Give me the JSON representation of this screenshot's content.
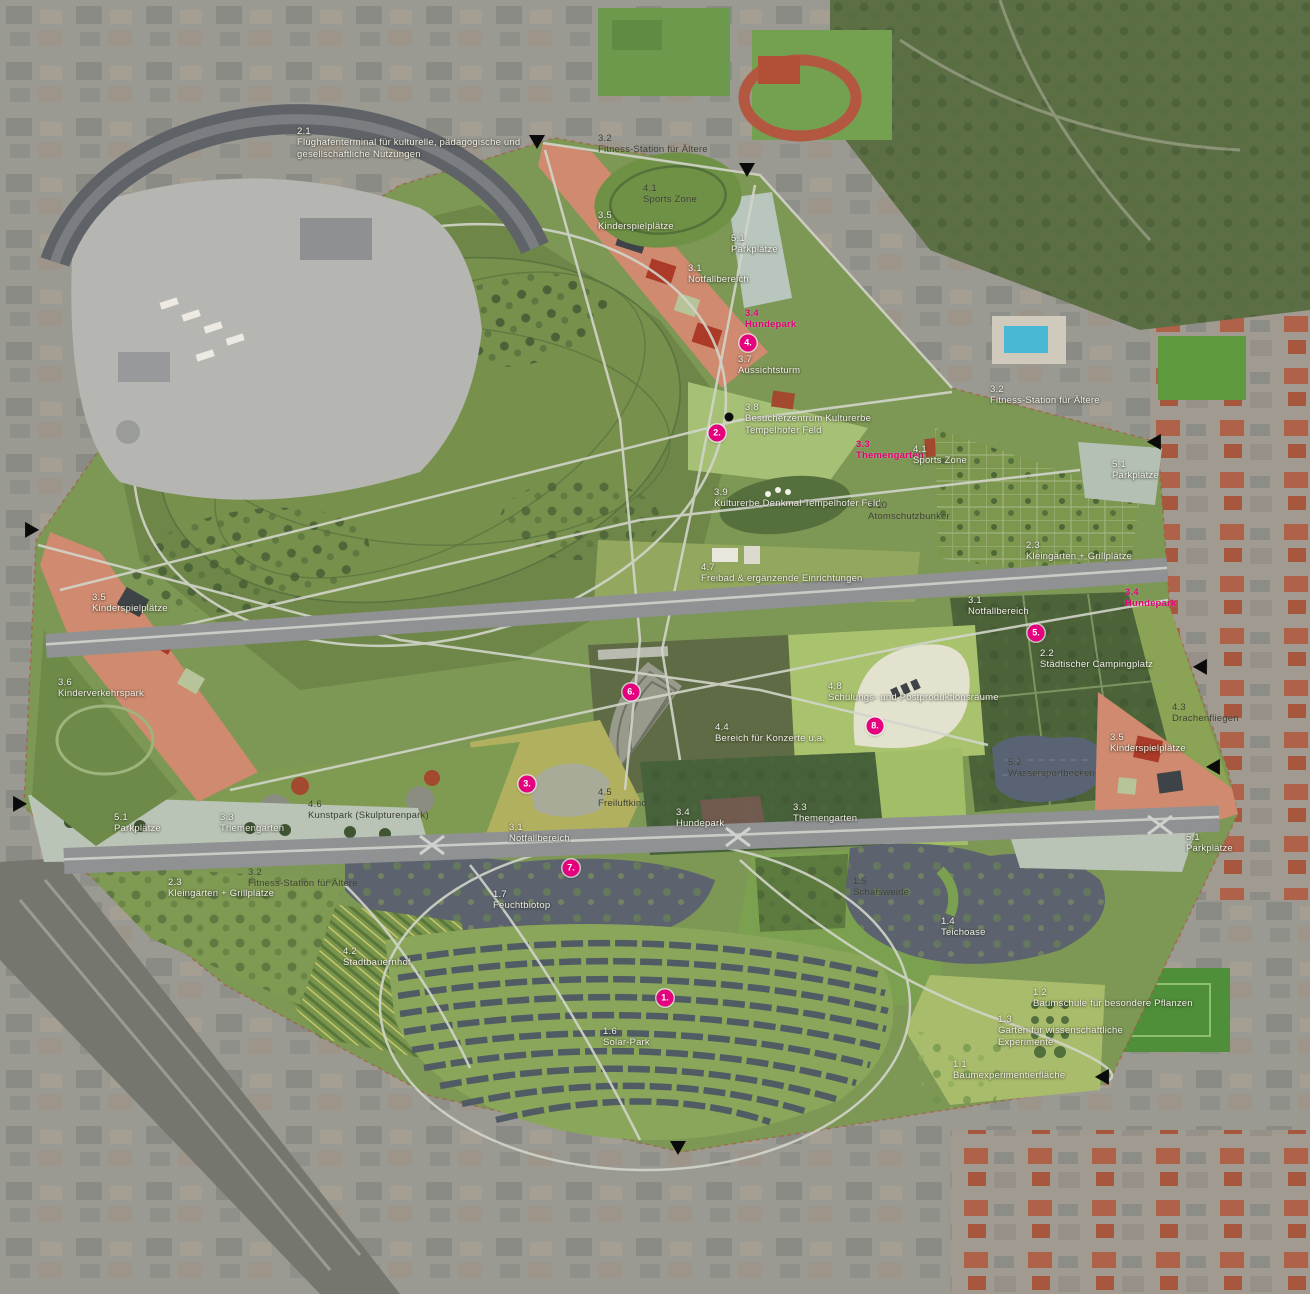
{
  "map_title": "Tempelhofer Feld Masterplan – Luftbild mit Nutzungszonen",
  "palette": {
    "accent": "#e5007d",
    "label_light": "#f0efe6",
    "label_dark": "#3a3e31"
  },
  "zone_labels": [
    {
      "code": "2.1",
      "name": "Flughafenterminal für kulturelle, pädagogische und gesellschaftliche Nutzungen",
      "x": 297,
      "y": 126,
      "tone": "light",
      "w": 275
    },
    {
      "code": "3.2",
      "name": "Fitness-Station für Ältere",
      "x": 598,
      "y": 133,
      "tone": "dark",
      "w": 170
    },
    {
      "code": "4.1",
      "name": "Sports Zone",
      "x": 643,
      "y": 183,
      "tone": "dark"
    },
    {
      "code": "3.5",
      "name": "Kinderspielplätze",
      "x": 598,
      "y": 210,
      "tone": "light"
    },
    {
      "code": "5.1",
      "name": "Parkplätze",
      "x": 731,
      "y": 233,
      "tone": "light"
    },
    {
      "code": "3.1",
      "name": "Notfallbereich",
      "x": 688,
      "y": 263,
      "tone": "light"
    },
    {
      "code": "3.4",
      "name": "Hundepark",
      "x": 745,
      "y": 308,
      "tone": "magenta"
    },
    {
      "code": "3.7",
      "name": "Aussichtsturm",
      "x": 738,
      "y": 354,
      "tone": "light"
    },
    {
      "code": "3.8",
      "name": "Besucherzentrum Kulturerbe Tempelhofer Feld",
      "x": 745,
      "y": 402,
      "tone": "light",
      "w": 165
    },
    {
      "code": "3.3",
      "name": "Themengarten",
      "x": 856,
      "y": 439,
      "tone": "magenta"
    },
    {
      "code": "4.1",
      "name": "Sports Zone",
      "x": 913,
      "y": 444,
      "tone": "light"
    },
    {
      "code": "3.2",
      "name": "Fitness-Station für Ältere",
      "x": 990,
      "y": 384,
      "tone": "light",
      "w": 220
    },
    {
      "code": "5.1",
      "name": "Parkplätze",
      "x": 1112,
      "y": 459,
      "tone": "light"
    },
    {
      "code": "3.9",
      "name": "Kulturerbe Denkmal Tempelhofer Feld",
      "x": 714,
      "y": 487,
      "tone": "light",
      "w": 230
    },
    {
      "code": "3.10",
      "name": "Atomschutzbunker",
      "x": 868,
      "y": 500,
      "tone": "dark"
    },
    {
      "code": "2.3",
      "name": "Kleingärten + Grillplätze",
      "x": 1026,
      "y": 540,
      "tone": "light",
      "w": 170
    },
    {
      "code": "4.7",
      "name": "Freibad & ergänzende Einrichtungen",
      "x": 701,
      "y": 562,
      "tone": "light",
      "w": 235
    },
    {
      "code": "3.5",
      "name": "Kinderspielplätze",
      "x": 92,
      "y": 592,
      "tone": "light"
    },
    {
      "code": "3.6",
      "name": "Kinderverkehrspark",
      "x": 58,
      "y": 677,
      "tone": "light",
      "w": 130
    },
    {
      "code": "3.1",
      "name": "Notfallbereich",
      "x": 968,
      "y": 595,
      "tone": "light"
    },
    {
      "code": "3.4",
      "name": "Hundepark",
      "x": 1125,
      "y": 587,
      "tone": "magenta"
    },
    {
      "code": "2.2",
      "name": "Städtischer Campingplatz",
      "x": 1040,
      "y": 648,
      "tone": "light",
      "w": 200
    },
    {
      "code": "4.3",
      "name": "Drachenfliegen",
      "x": 1172,
      "y": 702,
      "tone": "dark",
      "w": 110
    },
    {
      "code": "4.8",
      "name": "Schulungs- und Postproduktionsräume",
      "x": 828,
      "y": 681,
      "tone": "light",
      "w": 265
    },
    {
      "code": "4.4",
      "name": "Bereich für Konzerte u.a.",
      "x": 715,
      "y": 722,
      "tone": "light",
      "w": 200
    },
    {
      "code": "5.2",
      "name": "Wassersportbecken",
      "x": 1008,
      "y": 757,
      "tone": "dark",
      "w": 140
    },
    {
      "code": "3.5",
      "name": "Kinderspielplätze",
      "x": 1110,
      "y": 732,
      "tone": "light"
    },
    {
      "code": "5.1",
      "name": "Parkplätze",
      "x": 114,
      "y": 812,
      "tone": "light"
    },
    {
      "code": "3.3",
      "name": "Themengarten",
      "x": 220,
      "y": 812,
      "tone": "light"
    },
    {
      "code": "4.6",
      "name": "Kunstpark (Skulpturenpark)",
      "x": 308,
      "y": 799,
      "tone": "dark",
      "w": 210
    },
    {
      "code": "4.5",
      "name": "Freiluftkino",
      "x": 598,
      "y": 787,
      "tone": "dark"
    },
    {
      "code": "3.1",
      "name": "Notfallbereich",
      "x": 509,
      "y": 822,
      "tone": "light"
    },
    {
      "code": "3.4",
      "name": "Hundepark",
      "x": 676,
      "y": 807,
      "tone": "light"
    },
    {
      "code": "3.3",
      "name": "Themengarten",
      "x": 793,
      "y": 802,
      "tone": "light"
    },
    {
      "code": "2.3",
      "name": "Kleingärten + Grillplätze",
      "x": 168,
      "y": 877,
      "tone": "light",
      "w": 175
    },
    {
      "code": "3.2",
      "name": "Fitness-Station für Ältere",
      "x": 248,
      "y": 867,
      "tone": "dark",
      "w": 210
    },
    {
      "code": "1.7",
      "name": "Feuchtbiotop",
      "x": 493,
      "y": 889,
      "tone": "light"
    },
    {
      "code": "1.5",
      "name": "Schafsweide",
      "x": 853,
      "y": 876,
      "tone": "dark"
    },
    {
      "code": "1.4",
      "name": "Teichoase",
      "x": 941,
      "y": 916,
      "tone": "light"
    },
    {
      "code": "5.1",
      "name": "Parkplätze",
      "x": 1186,
      "y": 832,
      "tone": "light"
    },
    {
      "code": "4.2",
      "name": "Stadtbauernhof",
      "x": 343,
      "y": 946,
      "tone": "light"
    },
    {
      "code": "1.6",
      "name": "Solar-Park",
      "x": 603,
      "y": 1026,
      "tone": "light"
    },
    {
      "code": "1.2",
      "name": "Baumschule für besondere Pflanzen",
      "x": 1033,
      "y": 987,
      "tone": "light",
      "w": 160
    },
    {
      "code": "1.3",
      "name": "Garten für wissenschaftliche Experimente",
      "x": 998,
      "y": 1014,
      "tone": "light",
      "w": 175
    },
    {
      "code": "1.1",
      "name": "Baumexperimentierfläche",
      "x": 953,
      "y": 1059,
      "tone": "light",
      "w": 225
    }
  ],
  "numbered_markers": [
    {
      "label": "1.",
      "x": 665,
      "y": 998
    },
    {
      "label": "2.",
      "x": 717,
      "y": 433
    },
    {
      "label": "3.",
      "x": 527,
      "y": 784
    },
    {
      "label": "4.",
      "x": 748,
      "y": 343
    },
    {
      "label": "5.",
      "x": 1036,
      "y": 633
    },
    {
      "label": "6.",
      "x": 631,
      "y": 692
    },
    {
      "label": "7.",
      "x": 571,
      "y": 868
    },
    {
      "label": "8.",
      "x": 875,
      "y": 726
    }
  ],
  "poi_dots": [
    {
      "x": 729,
      "y": 417
    }
  ],
  "edge_markers": [
    {
      "x": 537,
      "y": 140,
      "dir": "down"
    },
    {
      "x": 747,
      "y": 168,
      "dir": "down"
    },
    {
      "x": 30,
      "y": 530,
      "dir": "right"
    },
    {
      "x": 18,
      "y": 804,
      "dir": "right"
    },
    {
      "x": 1156,
      "y": 442,
      "dir": "left"
    },
    {
      "x": 1202,
      "y": 667,
      "dir": "left"
    },
    {
      "x": 1215,
      "y": 767,
      "dir": "left"
    },
    {
      "x": 1104,
      "y": 1077,
      "dir": "left"
    },
    {
      "x": 678,
      "y": 1146,
      "dir": "down"
    }
  ]
}
